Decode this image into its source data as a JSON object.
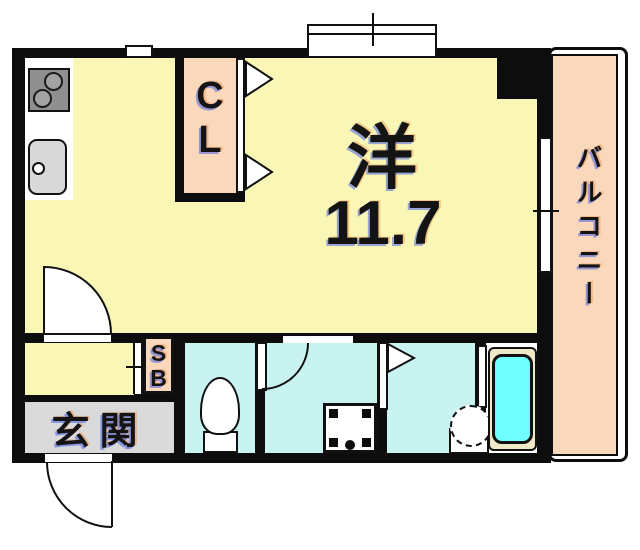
{
  "plan": {
    "rooms": {
      "main": {
        "name_label": "洋",
        "size_label": "11.7"
      },
      "closet": {
        "letter_top": "C",
        "letter_bottom": "L"
      },
      "balcony": {
        "label": "バルコニー"
      },
      "entrance": {
        "label": "玄関"
      },
      "shoe_box": {
        "letter_top": "S",
        "letter_bottom": "B"
      }
    },
    "colors": {
      "room_yellow": "#f9f6b6",
      "closet_balcony_peach": "#fad8bb",
      "wet_area_cyan": "#c9f3f1",
      "bathtub_cyan": "#6fffff",
      "entrance_gray": "#dadada",
      "wall_black": "#0d0d0d",
      "tub_deck_cream": "#f0e8c6"
    }
  }
}
